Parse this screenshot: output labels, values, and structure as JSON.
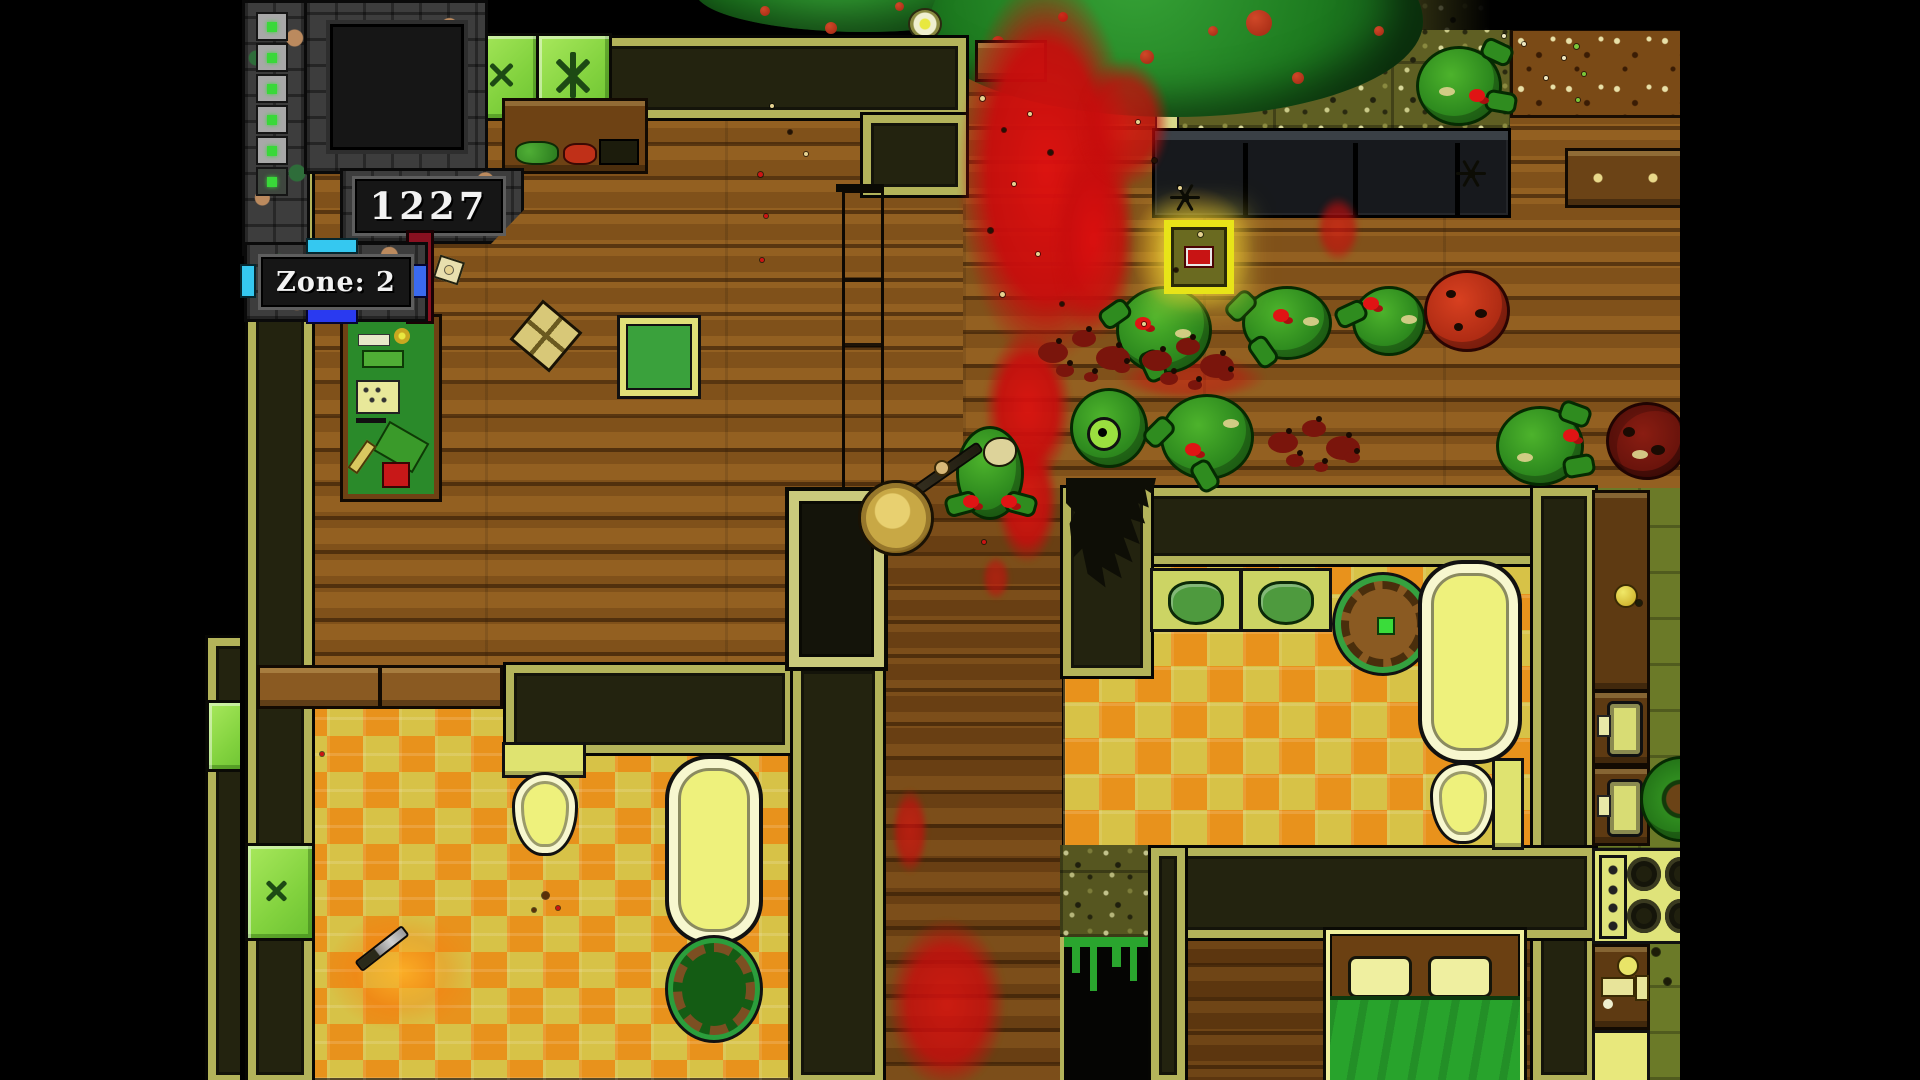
{
  "meta": {
    "game_view": "top-down pixel-art zombie house interior, 4:3 letterboxed"
  },
  "hud": {
    "score": "1227",
    "zone_label": "Zone: 2",
    "health_cells_total": 6,
    "health_cells_bright": 5
  },
  "palette": {
    "letterbox": "#000000",
    "wood_light": "#8a571c",
    "wood_dark": "#714414",
    "wall_fill": "#23230f",
    "wall_trim": "#b3b35a",
    "checker_orange": "#e8921c",
    "checker_yellow": "#d7c247",
    "blood": "#d01010",
    "zombie_green": "#2f8c1f",
    "window_green": "#8ee04a",
    "hud_stone": "#3d3d3d",
    "accent_cyan": "#35c8f0",
    "accent_blue": "#2a3af0",
    "medkit_yellow": "#e8e418",
    "bed_blanket": "#28a32c"
  },
  "entities": {
    "zombies": [
      {
        "x": 876,
        "y": 286,
        "w": 90,
        "h": 82,
        "v": "green",
        "arms": [
          [
            -20,
            14,
            -35
          ],
          [
            18,
            66,
            65
          ]
        ],
        "wound": [
          16,
          28
        ],
        "spot": [
          56,
          40
        ]
      },
      {
        "x": 1002,
        "y": 286,
        "w": 84,
        "h": 68,
        "v": "green",
        "arms": [
          [
            -20,
            6,
            -45
          ],
          [
            2,
            52,
            55
          ]
        ],
        "wound": [
          28,
          20
        ],
        "spot": [
          58,
          28
        ]
      },
      {
        "x": 1112,
        "y": 286,
        "w": 68,
        "h": 64,
        "v": "green",
        "arms": [
          [
            -20,
            14,
            -25
          ]
        ],
        "wound": [
          8,
          8
        ],
        "spot": [
          46,
          26
        ]
      },
      {
        "x": 716,
        "y": 426,
        "w": 62,
        "h": 88,
        "v": "skull",
        "arms": [
          [
            -14,
            64,
            -15
          ],
          [
            46,
            64,
            15
          ]
        ],
        "wound": [
          4,
          66
        ],
        "wound2": [
          42,
          66
        ],
        "skull": [
          24,
          8
        ]
      },
      {
        "x": 830,
        "y": 388,
        "w": 72,
        "h": 74,
        "v": "eyedead",
        "eye": [
          14,
          26
        ]
      },
      {
        "x": 920,
        "y": 394,
        "w": 88,
        "h": 80,
        "v": "green",
        "arms": [
          [
            -20,
            24,
            -45
          ],
          [
            26,
            68,
            60
          ]
        ],
        "wound": [
          22,
          46
        ],
        "spot": [
          60,
          22
        ]
      },
      {
        "x": 1176,
        "y": 46,
        "w": 80,
        "h": 74,
        "v": "green",
        "arms": [
          [
            62,
            -8,
            25
          ],
          [
            66,
            42,
            10
          ]
        ],
        "wound": [
          50,
          40
        ],
        "spot": [
          20,
          38
        ]
      },
      {
        "x": 1256,
        "y": 406,
        "w": 82,
        "h": 74,
        "v": "green",
        "arms": [
          [
            60,
            -6,
            20
          ],
          [
            64,
            46,
            -10
          ]
        ],
        "wound": [
          64,
          20
        ],
        "spot": [
          18,
          44
        ]
      },
      {
        "x": 1366,
        "y": 402,
        "w": 76,
        "h": 72,
        "v": "deadred"
      },
      {
        "x": 1184,
        "y": 270,
        "w": 80,
        "h": 76,
        "v": "tomato"
      },
      {
        "x": 1400,
        "y": 756,
        "w": 76,
        "h": 80,
        "v": "curl"
      },
      {
        "x": 798,
        "y": 328,
        "w": 100,
        "h": 66,
        "v": "splat"
      },
      {
        "x": 902,
        "y": 336,
        "w": 112,
        "h": 60,
        "v": "splat"
      },
      {
        "x": 1028,
        "y": 418,
        "w": 102,
        "h": 54,
        "v": "splat"
      }
    ],
    "blood": [
      {
        "x": 718,
        "y": -24,
        "w": 176,
        "h": 390,
        "o": 0.95
      },
      {
        "x": 812,
        "y": 140,
        "w": 84,
        "h": 200,
        "o": 0.8
      },
      {
        "x": 838,
        "y": 58,
        "w": 92,
        "h": 130,
        "o": 0.75
      },
      {
        "x": 744,
        "y": 330,
        "w": 88,
        "h": 156,
        "o": 0.9
      },
      {
        "x": 756,
        "y": 438,
        "w": 62,
        "h": 126,
        "o": 0.85
      },
      {
        "x": 648,
        "y": 918,
        "w": 118,
        "h": 172,
        "o": 0.8
      },
      {
        "x": 652,
        "y": 788,
        "w": 36,
        "h": 86,
        "o": 0.65
      },
      {
        "x": 876,
        "y": 356,
        "w": 150,
        "h": 44,
        "o": 0.45
      },
      {
        "x": 1076,
        "y": 196,
        "w": 44,
        "h": 66,
        "o": 0.6
      },
      {
        "x": 742,
        "y": 556,
        "w": 28,
        "h": 44,
        "o": 0.55
      }
    ],
    "debris": [
      [
        740,
        96,
        5,
        "#e6d391"
      ],
      [
        762,
        128,
        4,
        "#241204"
      ],
      [
        788,
        112,
        4,
        "#e6d391"
      ],
      [
        808,
        150,
        5,
        "#241204"
      ],
      [
        772,
        182,
        4,
        "#e6d391"
      ],
      [
        748,
        228,
        5,
        "#241204"
      ],
      [
        796,
        252,
        4,
        "#e6d391"
      ],
      [
        760,
        292,
        5,
        "#e6d391"
      ],
      [
        820,
        302,
        4,
        "#241204"
      ],
      [
        896,
        120,
        4,
        "#e6d391"
      ],
      [
        912,
        158,
        5,
        "#241204"
      ],
      [
        938,
        186,
        4,
        "#e6d391"
      ],
      [
        958,
        232,
        5,
        "#e6d391"
      ],
      [
        934,
        268,
        4,
        "#241204"
      ],
      [
        902,
        322,
        4,
        "#e6d391"
      ],
      [
        530,
        104,
        4,
        "#e6d391"
      ],
      [
        548,
        130,
        4,
        "#241204"
      ],
      [
        564,
        152,
        4,
        "#e6d391"
      ],
      [
        518,
        172,
        5,
        "#cc1414"
      ],
      [
        524,
        214,
        4,
        "#cc1414"
      ],
      [
        520,
        258,
        4,
        "#cc1414"
      ],
      [
        742,
        540,
        4,
        "#cc1414"
      ],
      [
        302,
        892,
        7,
        "#5a3008"
      ],
      [
        316,
        906,
        4,
        "#cc1414"
      ],
      [
        292,
        908,
        4,
        "#5a3008"
      ],
      [
        1334,
        44,
        5,
        "#7ac83a"
      ],
      [
        1342,
        72,
        4,
        "#7ac83a"
      ],
      [
        1336,
        98,
        4,
        "#7ac83a"
      ],
      [
        1282,
        42,
        4,
        "#efe9c2"
      ],
      [
        1304,
        76,
        4,
        "#efe9c2"
      ],
      [
        1322,
        56,
        4,
        "#efe9c2"
      ],
      [
        1262,
        34,
        4,
        "#efe9c2"
      ],
      [
        1412,
        948,
        8,
        "#1c1c08"
      ],
      [
        1424,
        978,
        7,
        "#1c1c08"
      ],
      [
        1396,
        600,
        6,
        "#1c1c08"
      ],
      [
        80,
        752,
        4,
        "#cc1414"
      ],
      [
        205,
        266,
        8,
        "#e6d391"
      ]
    ],
    "canopy_tomatoes": [
      [
        520,
        6,
        10
      ],
      [
        585,
        22,
        12
      ],
      [
        655,
        2,
        9
      ],
      [
        752,
        36,
        12
      ],
      [
        818,
        12,
        10
      ],
      [
        900,
        50,
        14
      ],
      [
        1006,
        10,
        26
      ],
      [
        1052,
        72,
        12
      ],
      [
        1134,
        26,
        10
      ],
      [
        968,
        26,
        10
      ]
    ],
    "items": {
      "medkit": {
        "x": 924,
        "y": 220,
        "w": 56,
        "h": 60
      },
      "knife": {
        "x": 112,
        "y": 942,
        "rot": -38,
        "glow": {
          "x": 86,
          "y": 912,
          "w": 150,
          "h": 120
        }
      },
      "yellow_ball": {
        "x": 1374,
        "y": 584,
        "d": 20
      },
      "flower": {
        "x": 668,
        "y": 8,
        "d": 30
      }
    },
    "player": {
      "hat": {
        "x": 618,
        "y": 480,
        "d": 70
      },
      "staff": {
        "x": 652,
        "y": 502,
        "len": 104,
        "rot": -35
      },
      "hand": [
        694,
        460
      ]
    },
    "bugs": [
      {
        "x": 930,
        "y": 182
      },
      {
        "x": 1216,
        "y": 158
      }
    ]
  }
}
